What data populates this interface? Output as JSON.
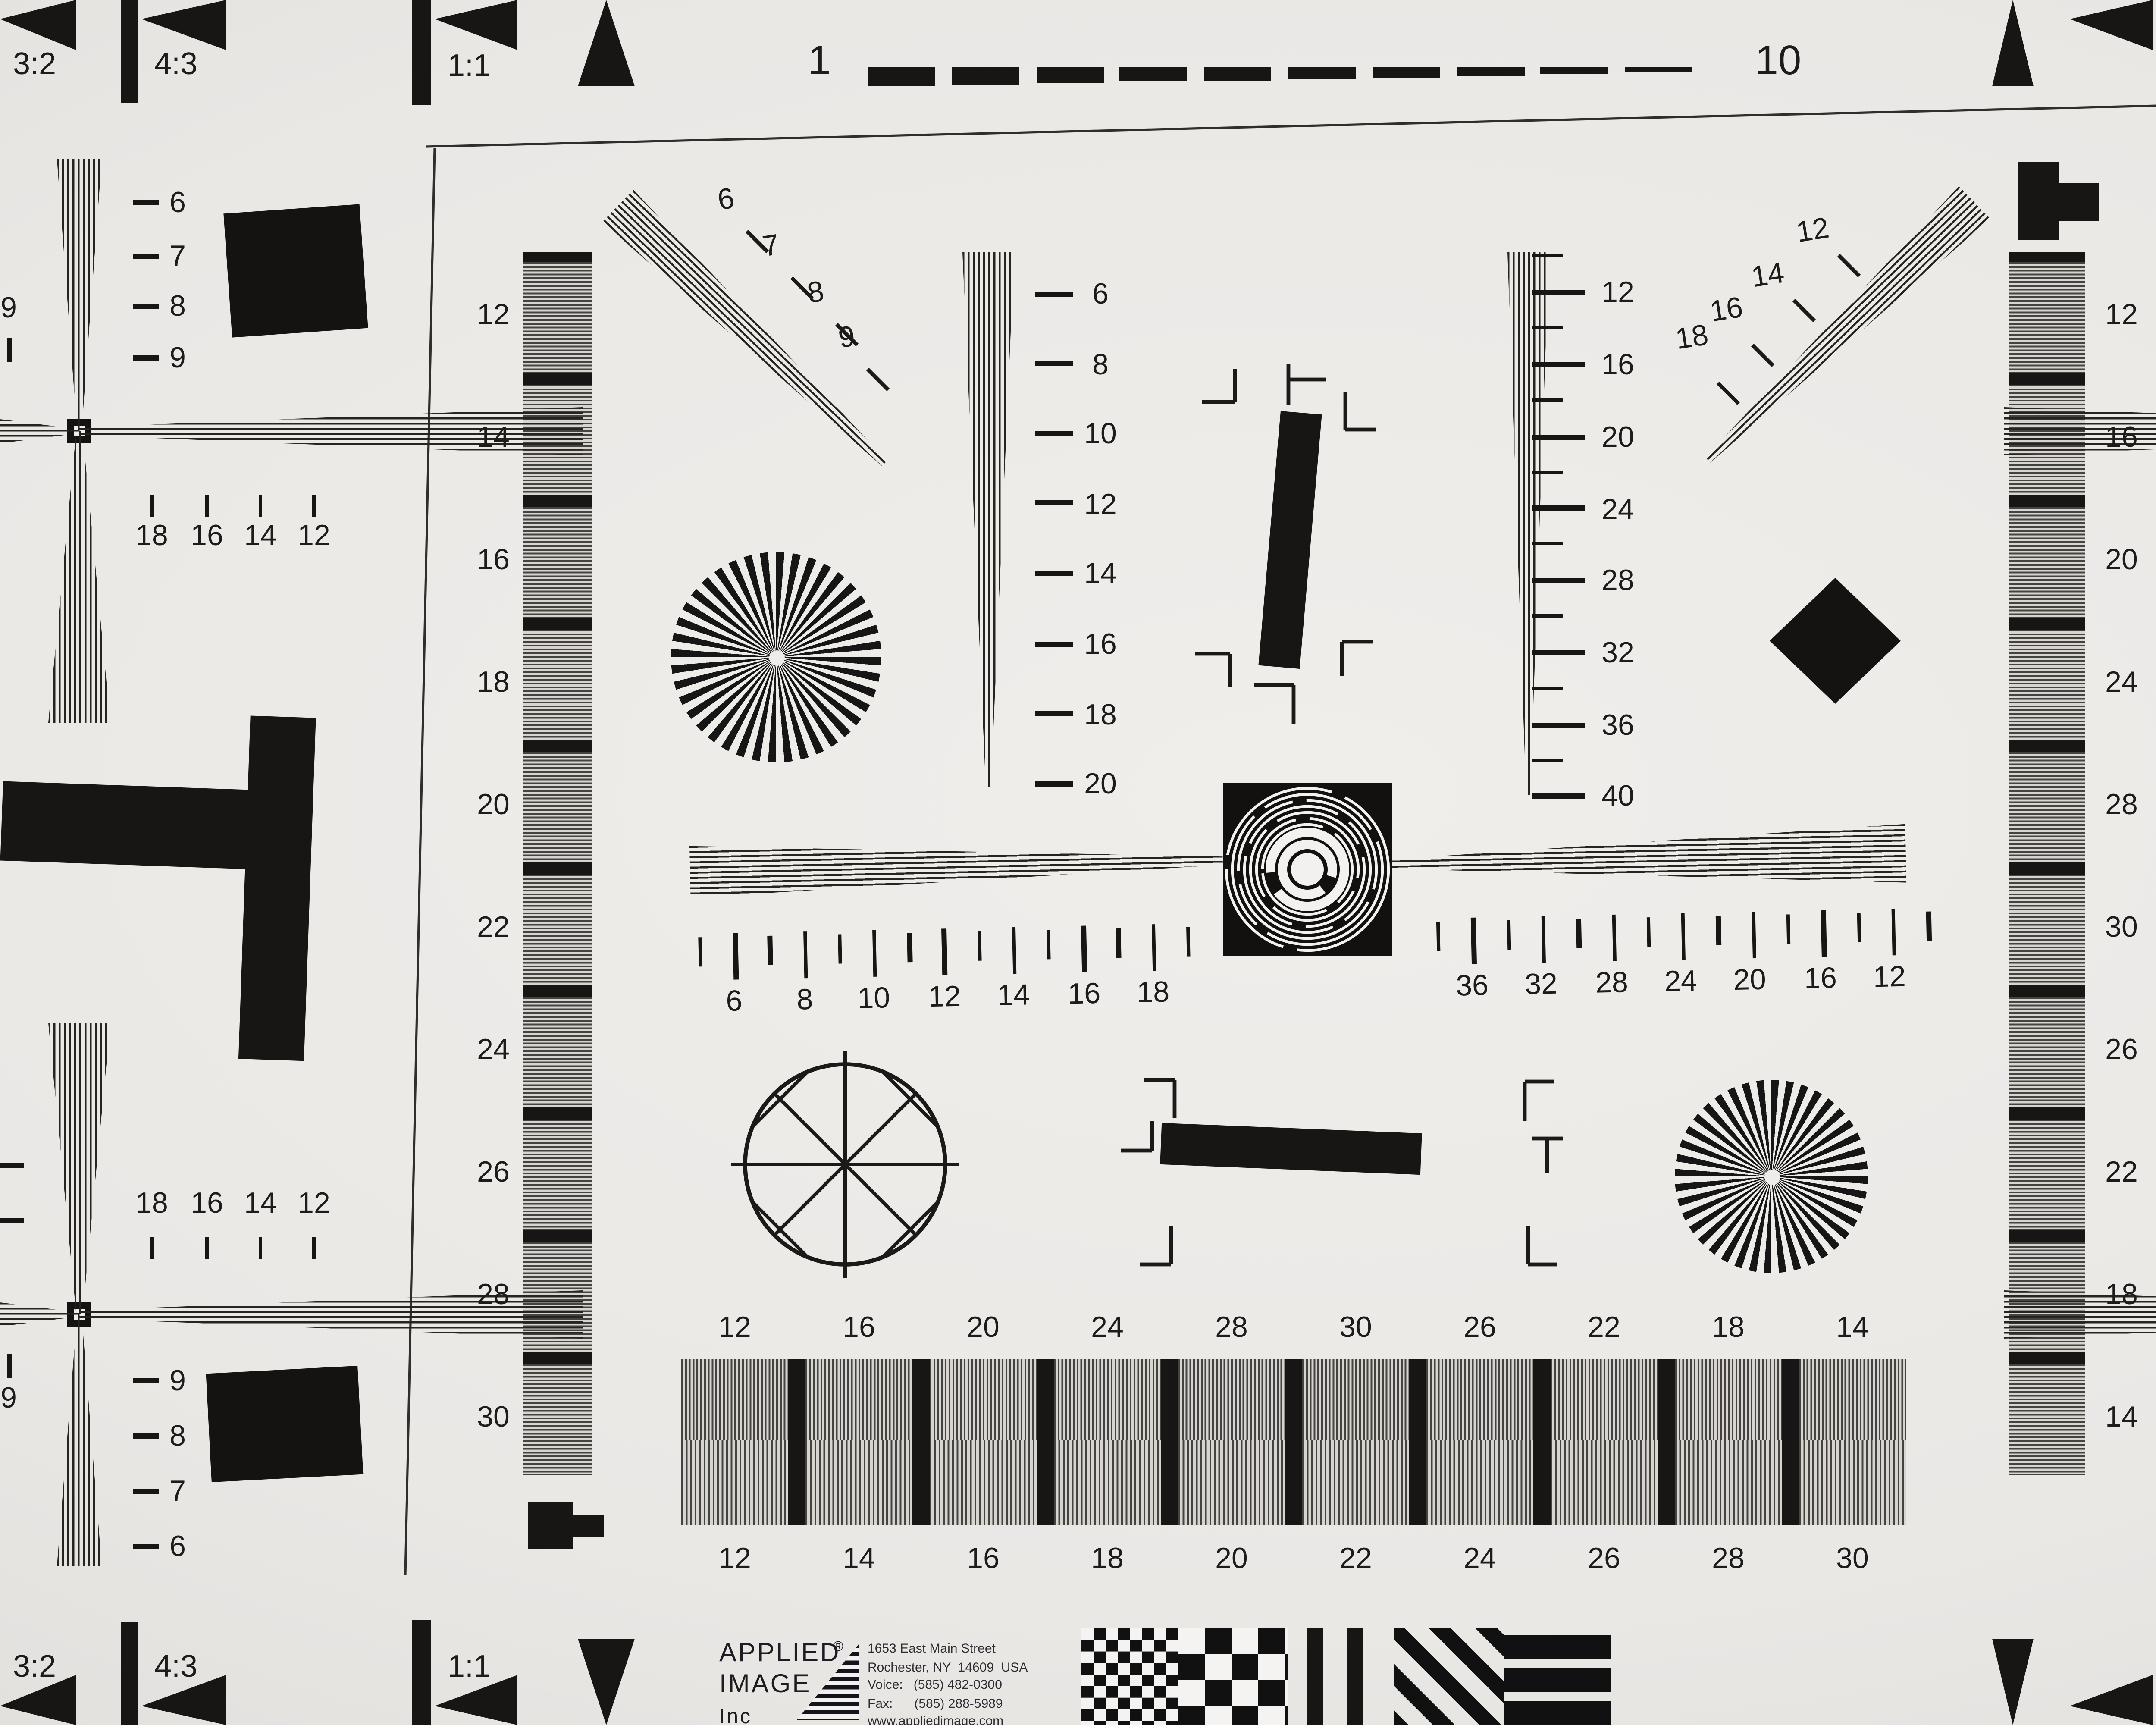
{
  "chart": {
    "maker": "APPLIED IMAGE Inc",
    "type_hint": "ISO-12233-style resolution test chart photograph"
  },
  "edge": {
    "top": [
      "3:2",
      "4:3",
      "1:1",
      "1",
      "10",
      "1:1",
      "4:3",
      "3:2"
    ],
    "bottom": [
      "3:2",
      "4:3",
      "1:1",
      "1:1",
      "4:3",
      "3:2"
    ]
  },
  "scales": {
    "corner_tl": [
      "18",
      "16",
      "14",
      "12"
    ],
    "corner_tr": [
      "12",
      "14",
      "16",
      "18"
    ],
    "corner_bl": [
      "18",
      "16",
      "14",
      "12"
    ],
    "corner_br": [
      "12",
      "14",
      "16",
      "18"
    ],
    "diag_tl": [
      "6",
      "7",
      "8",
      "9"
    ],
    "diag_tr": [
      "12",
      "14",
      "16",
      "18"
    ],
    "col_tl": [
      "6",
      "7",
      "8",
      "9"
    ],
    "col_tr": [
      "6",
      "7",
      "8",
      "9"
    ],
    "col_bl": [
      "9",
      "8",
      "7",
      "6"
    ],
    "col_br": [
      "9",
      "8",
      "7",
      "6"
    ],
    "edge_marker": "9",
    "wedge_left": [
      "6",
      "8",
      "10",
      "12",
      "14",
      "16",
      "18",
      "20"
    ],
    "wedge_right": [
      "12",
      "16",
      "20",
      "24",
      "28",
      "32",
      "36",
      "40"
    ],
    "ruler_left": [
      "6",
      "8",
      "10",
      "12",
      "14",
      "16",
      "18"
    ],
    "ruler_right": [
      "36",
      "32",
      "28",
      "24",
      "20",
      "16",
      "12"
    ],
    "gray_left": [
      "12",
      "14",
      "16",
      "18",
      "20",
      "22",
      "24",
      "26",
      "28",
      "30"
    ],
    "gray_right": [
      "12",
      "16",
      "20",
      "24",
      "28",
      "30",
      "26",
      "22",
      "18",
      "14"
    ],
    "bottom_top": [
      "12",
      "16",
      "20",
      "24",
      "28",
      "30",
      "26",
      "22",
      "18",
      "14"
    ],
    "bottom_bottom": [
      "12",
      "14",
      "16",
      "18",
      "20",
      "22",
      "24",
      "26",
      "28",
      "30"
    ]
  },
  "logo": {
    "name1": "APPLIED",
    "reg": "®",
    "name2": "IMAGE",
    "name3": "Inc",
    "address1": "1653 East Main Street",
    "address2": "Rochester, NY  14609  USA",
    "address3": "Voice:   (585) 482-0300",
    "address4": "Fax:      (585) 288-5989",
    "website": "www.appliedimage.com"
  },
  "colors": {
    "paper": "#EAE8E5",
    "ink": "#171614",
    "stripe_gray": "#A9A7A4",
    "shadow_edge": "#46261a"
  }
}
